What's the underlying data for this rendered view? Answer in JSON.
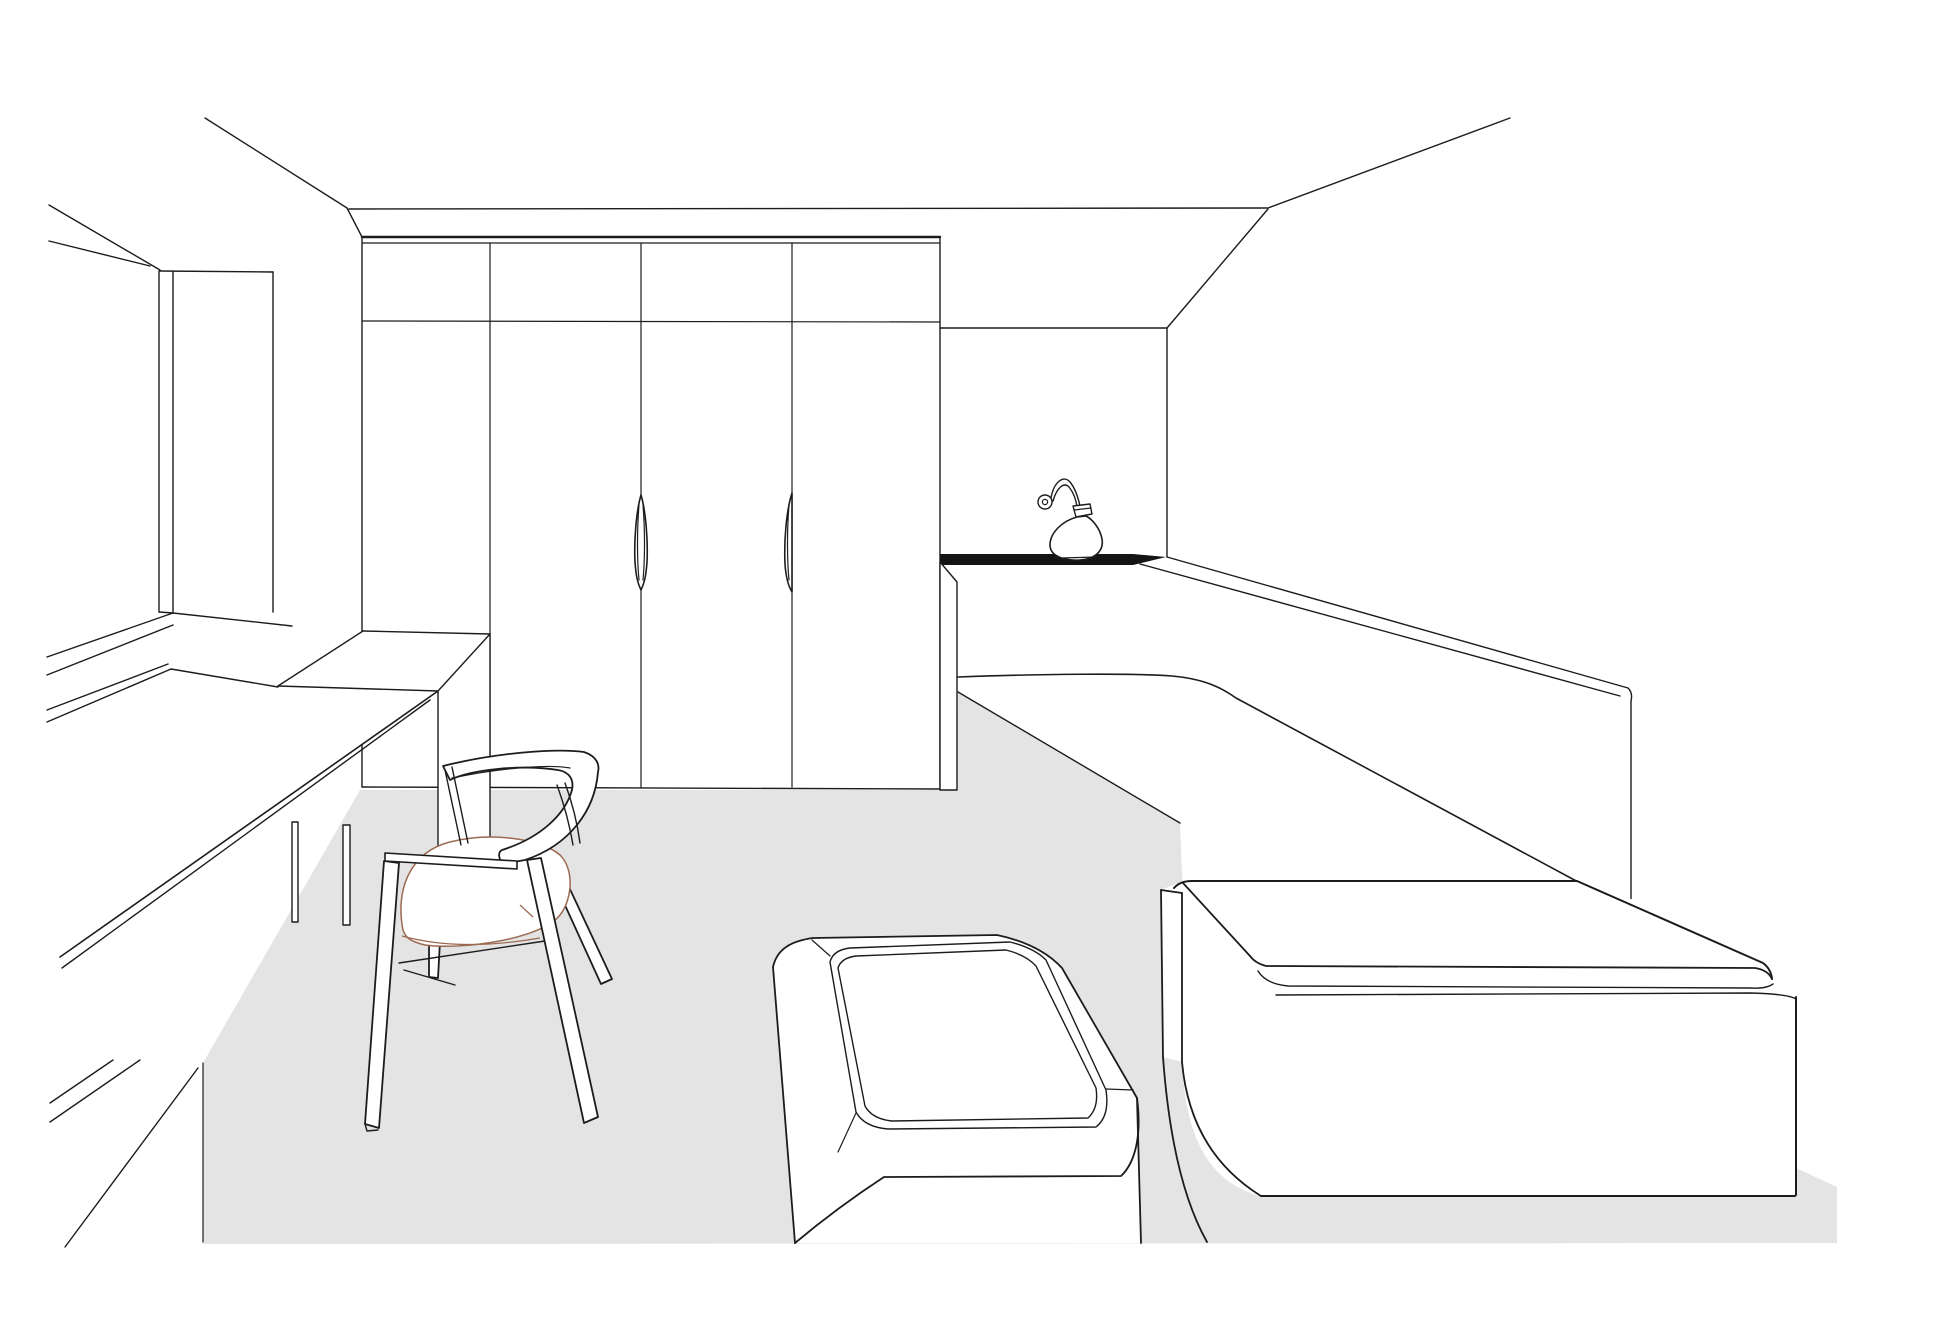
{
  "scene": {
    "title": "interior-line-drawing",
    "description": "Monochrome vector line drawing of a room interior in perspective: wardrobe with four doors, window on left wall, long desk, wooden chair with round cushion, upholstered daybed ottoman, built-in bench with back ledge, platform box with mattress cushion, wall lamp on a dark counter strip, sloped ceiling soffit at right, light grey floor area.",
    "canvas": {
      "width": 1955,
      "height": 1342
    }
  },
  "colors": {
    "background": "#ffffff",
    "line": "#1c1c1c",
    "floor": "#e4e4e4",
    "counter": "#141414",
    "cushion_outline": "#9c6a52"
  },
  "objects": [
    {
      "name": "ceiling-edges"
    },
    {
      "name": "window-frame"
    },
    {
      "name": "wardrobe",
      "doors": 4,
      "handles": 2
    },
    {
      "name": "desk"
    },
    {
      "name": "desk-return-cabinet"
    },
    {
      "name": "chair",
      "cushion": "round upholstered seat"
    },
    {
      "name": "ottoman-daybed",
      "top": "inset rounded panel"
    },
    {
      "name": "bench",
      "parts": [
        "counter-strip",
        "back-ledge",
        "seat",
        "end-panel"
      ]
    },
    {
      "name": "wall-lamp",
      "style": "gooseneck with teardrop shade"
    },
    {
      "name": "platform-box"
    },
    {
      "name": "mattress-cushion"
    },
    {
      "name": "floor-area"
    }
  ]
}
